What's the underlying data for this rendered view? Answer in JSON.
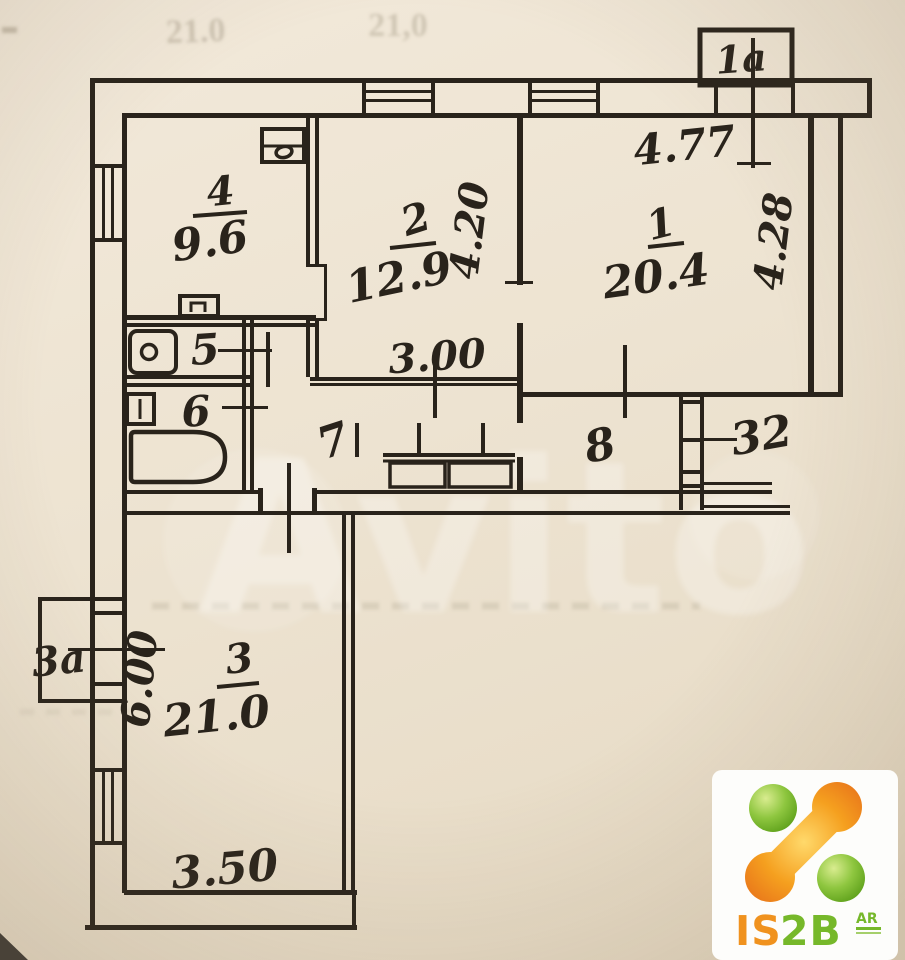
{
  "plan": {
    "ink": "#29231b",
    "paper": "#ece3d1",
    "rooms": {
      "r1": {
        "number": "1",
        "area": "20.4"
      },
      "r2": {
        "number": "2",
        "area": "12.9"
      },
      "r3": {
        "number": "3",
        "area": "21.0"
      },
      "r4": {
        "number": "4",
        "area": "9.6"
      },
      "r5": {
        "number": "5"
      },
      "r6": {
        "number": "6"
      },
      "r7": {
        "number": "7"
      },
      "r8": {
        "number": "8"
      }
    },
    "annexes": {
      "top": "1a",
      "left": "3a",
      "right": "32"
    },
    "dims": {
      "top_width": "4.77",
      "room1_depth": "4.28",
      "room2_depth": "4.20",
      "hall_width": "3.00",
      "room3_width": "3.50",
      "room3_depth": "6.00"
    },
    "ghost": {
      "left": "21.0",
      "right": "21,0"
    }
  },
  "watermark": {
    "text": "Avito"
  },
  "logo": {
    "is": "IS",
    "two_b": "2B",
    "badge": "AR",
    "green": "#76b82a",
    "orange": "#f0921e"
  }
}
